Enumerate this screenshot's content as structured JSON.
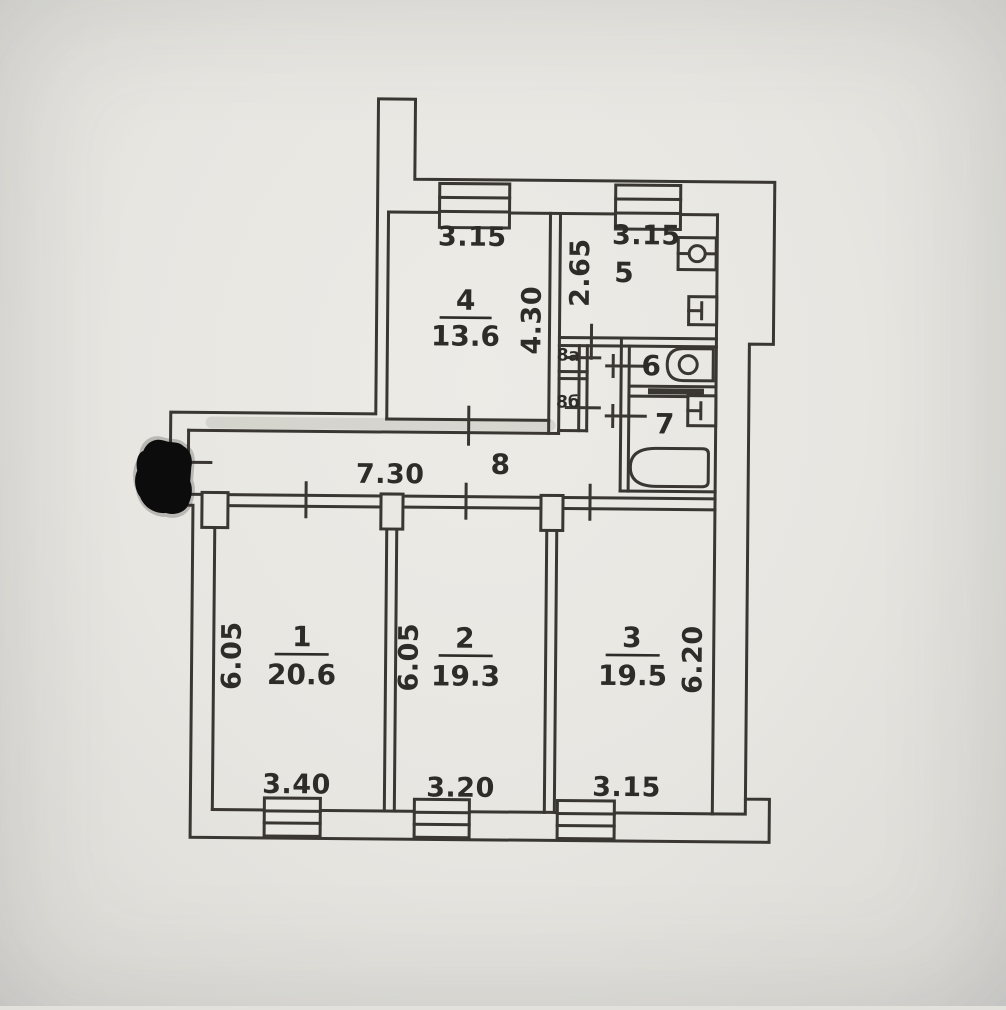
{
  "meta": {
    "title": "apartment-floor-plan-scan"
  },
  "colors": {
    "paper": "#e8e6e1",
    "ink": "#3a3733",
    "text": "#2e2c28",
    "marker": "#0c0c0c"
  },
  "rooms": {
    "r1": {
      "number": "1",
      "area": "20.6",
      "width": "3.40",
      "depth": "6.05"
    },
    "r2": {
      "number": "2",
      "area": "19.3",
      "width": "3.20",
      "depth": "6.05"
    },
    "r3": {
      "number": "3",
      "area": "19.5",
      "width": "3.15",
      "depth": "6.20"
    },
    "r4": {
      "number": "4",
      "area": "13.6",
      "width": "3.15",
      "depth": "4.30"
    },
    "r5": {
      "number": "5",
      "width": "3.15",
      "depth": "2.65"
    },
    "r6": {
      "number": "6"
    },
    "r7": {
      "number": "7"
    },
    "r8": {
      "number": "8",
      "length": "7.30"
    },
    "c8a": {
      "number": "8а"
    },
    "c8b": {
      "number": "8б"
    }
  }
}
